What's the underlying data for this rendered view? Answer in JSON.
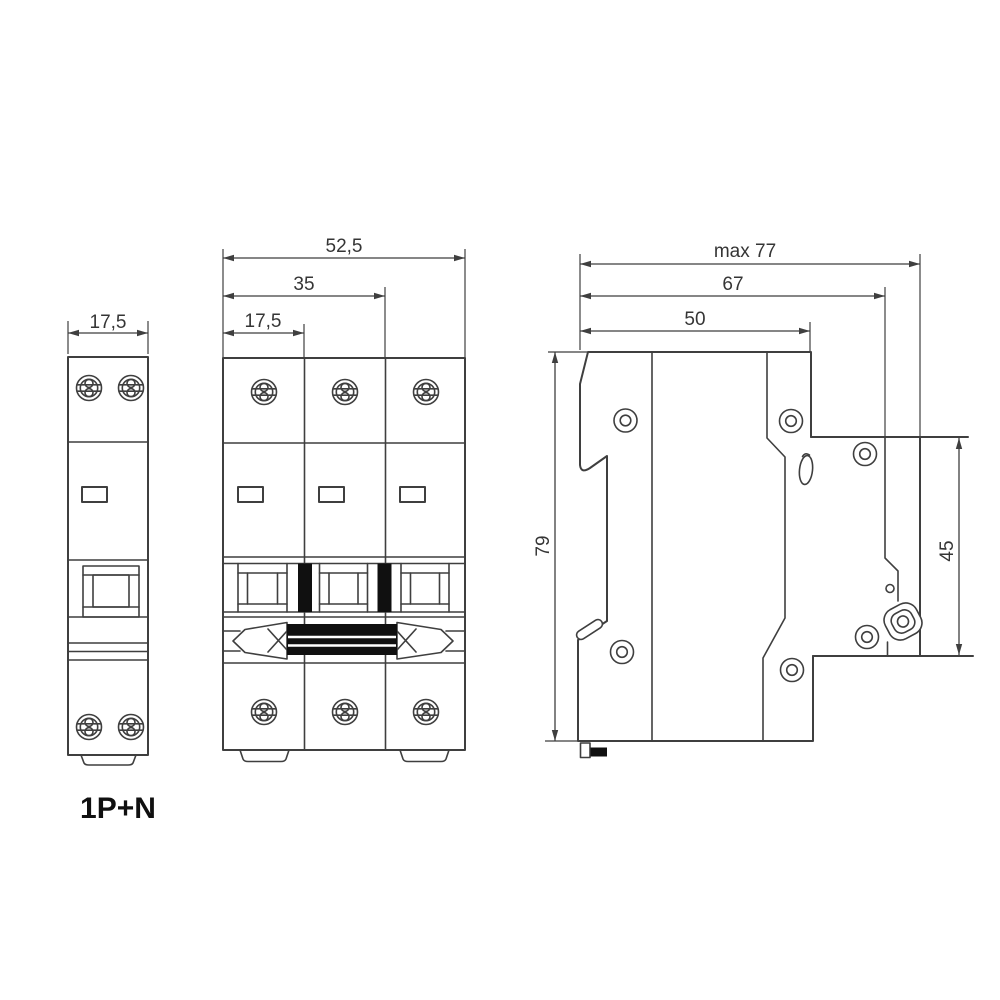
{
  "colors": {
    "background": "#ffffff",
    "line": "#3f3f3f",
    "text": "#353535",
    "ink": "#101010"
  },
  "views": {
    "front_1pn": {
      "name": "1P+N module front view",
      "dim_width": "17,5",
      "label": "1P+N"
    },
    "front_3p": {
      "name": "3-pole breaker front view",
      "dim_overall": "52,5",
      "dim_two_modules": "35",
      "dim_one_module": "17,5"
    },
    "side": {
      "name": "breaker side view",
      "dim_max_depth": "max 77",
      "dim_depth_terminal": "67",
      "dim_depth_top": "50",
      "dim_height": "79",
      "dim_front_height": "45"
    }
  }
}
